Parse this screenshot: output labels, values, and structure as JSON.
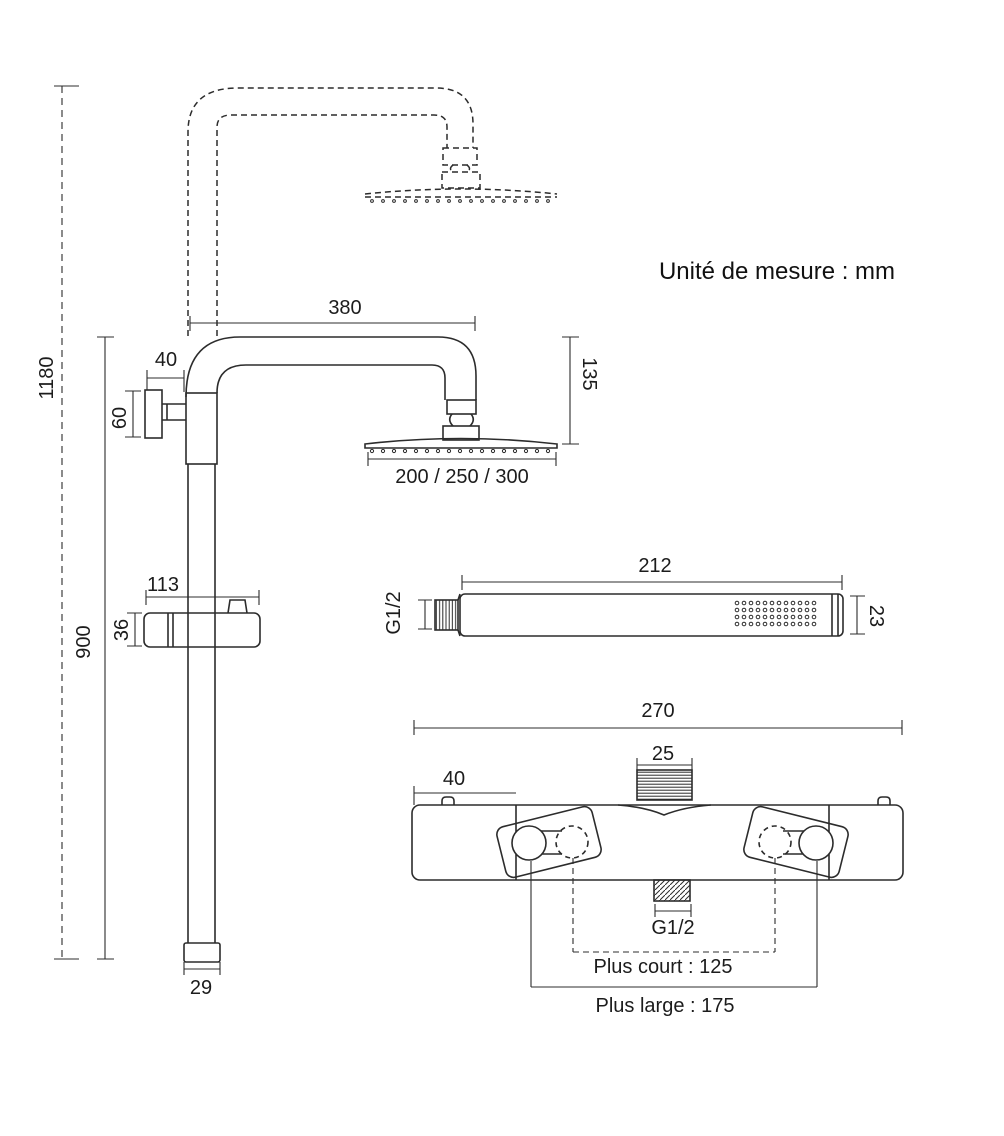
{
  "unit_note": "Unité de mesure : mm",
  "colors": {
    "line": "#2c2c2c",
    "text": "#1c1c1c",
    "background": "#ffffff"
  },
  "shower_column": {
    "overall_height_mm": "1180",
    "slide_rail_height_mm": "900",
    "arm_reach_mm": "380",
    "wall_bracket_offset_mm": "40",
    "wall_bracket_height_mm": "60",
    "head_drop_mm": "135",
    "head_diameters_mm": "200 / 250 / 300",
    "slider_holder_width_mm": "113",
    "slider_holder_height_mm": "36",
    "rail_end_cap_width_mm": "29"
  },
  "hand_shower": {
    "length_mm": "212",
    "inlet_thread": "G1/2",
    "diameter_mm": "23"
  },
  "mixer": {
    "body_width_mm": "270",
    "top_outlet_thread_width_mm": "25",
    "handle_end_offset_mm": "40",
    "bottom_outlet_thread": "G1/2",
    "handle_spacing_short": "Plus court : 125",
    "handle_spacing_wide": "Plus large : 175"
  }
}
